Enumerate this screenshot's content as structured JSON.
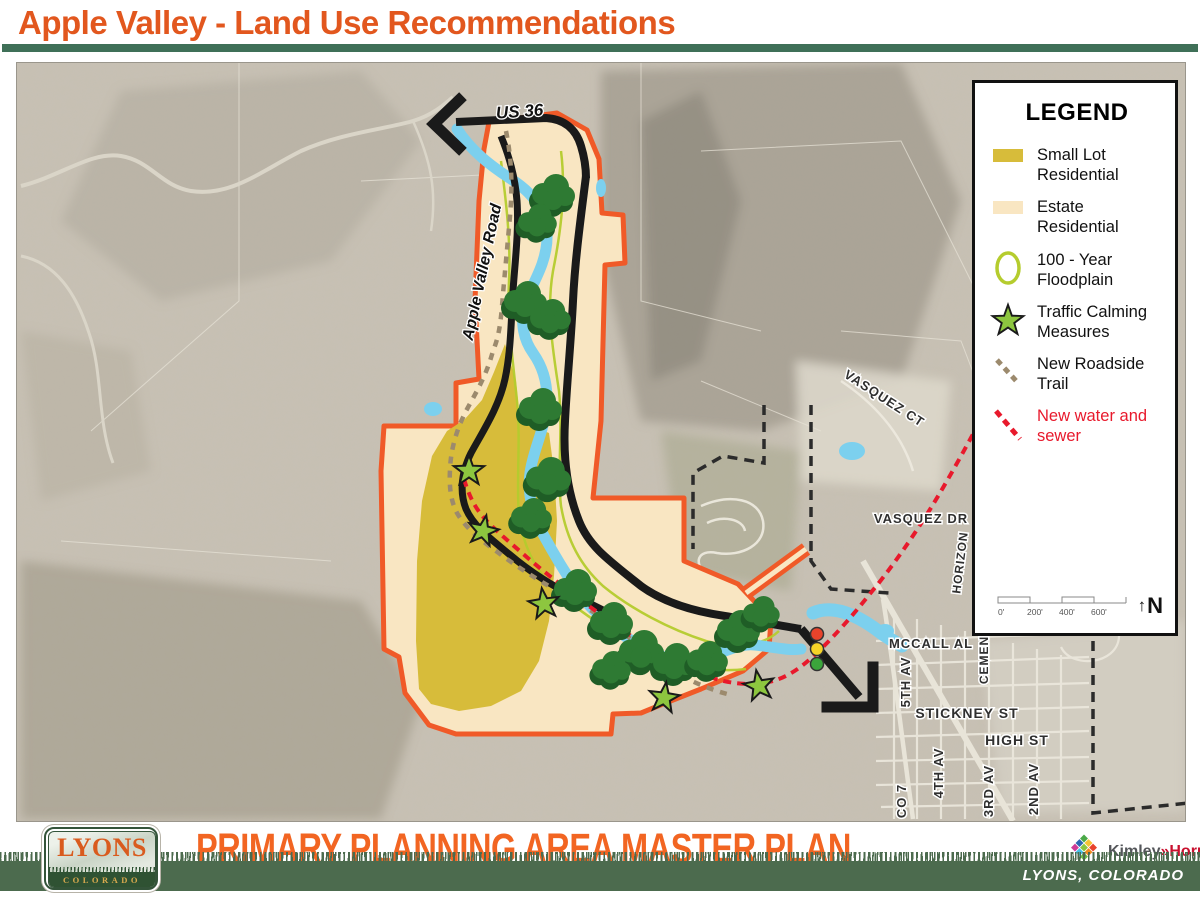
{
  "header": {
    "title": "Apple Valley - Land Use Recommendations"
  },
  "legend": {
    "title": "LEGEND",
    "items": [
      {
        "line1": "Small Lot",
        "line2": "Residential"
      },
      {
        "line1": "Estate Residential",
        "line2": ""
      },
      {
        "line1": "100 - Year",
        "line2": "Floodplain"
      },
      {
        "line1": "Traffic Calming",
        "line2": "Measures"
      },
      {
        "line1": "New Roadside",
        "line2": "Trail"
      },
      {
        "line1": "New water and",
        "line2": "sewer"
      }
    ],
    "scale_labels": [
      "0'",
      "200'",
      "400'",
      "600'"
    ],
    "north_arrow": "↑",
    "north_label": "N"
  },
  "map": {
    "labels": {
      "us36": "US 36",
      "apple_valley_road": "Apple Valley Road",
      "vasquez_ct": "VASQUEZ CT",
      "vasquez_dr": "VASQUEZ DR",
      "horizon": "HORIZON",
      "mccall_al": "MCCALL AL",
      "cemen": "CEMEN",
      "fifth_av": "5TH AV",
      "stickney_st": "STICKNEY ST",
      "high_st": "HIGH ST",
      "fourth_av": "4TH AV",
      "third_av": "3RD AV",
      "second_av": "2ND AV",
      "co_7": "CO 7"
    }
  },
  "footer": {
    "logo_title": "LYONS",
    "logo_subtitle": "COLORADO",
    "plan_title": "PRIMARY PLANNING AREA MASTER PLAN",
    "ricker": "Ricker|Cunningham",
    "kimley": "Kimley",
    "kimley_sep": "»",
    "horn": "Horn",
    "banner": "LYONS, COLORADO"
  },
  "colors": {
    "accent_orange": "#E2571E",
    "header_bar_green": "#3F7058",
    "boundary_orange": "#F05A28",
    "small_lot_gold": "#D7BC3A",
    "estate_tan": "#F9E6C2",
    "river_blue": "#7CD0EE",
    "floodplain_green": "#B5CC2E",
    "tree_green": "#2E7A33",
    "star_green": "#8DC63F",
    "trail_brown": "#9C8A6D",
    "water_sewer_red": "#E8192C",
    "footer_green": "#4C6B4E"
  }
}
